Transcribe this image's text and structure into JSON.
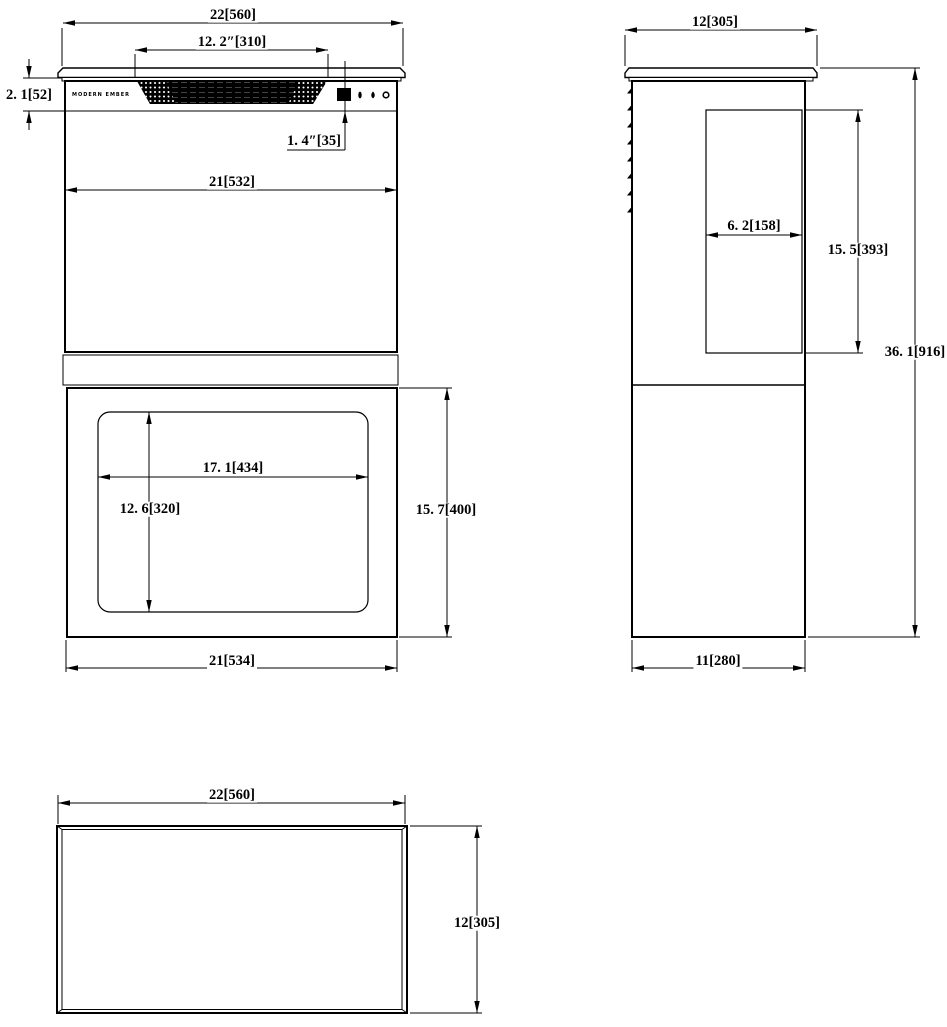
{
  "drawing_type": "three-view technical drawing",
  "brand_label": "MODERN EMBER",
  "colors": {
    "line": "#000000",
    "background": "#ffffff",
    "grille_fill": "#000000"
  },
  "dims": {
    "front": {
      "overall_width": "22[560]",
      "grille_width": "12. 2″[310]",
      "top_panel_height": "2. 1[52]",
      "display_width": "1. 4″[35]",
      "upper_body_width": "21[532]",
      "window_width": "17. 1[434]",
      "window_height": "12. 6[320]",
      "lower_box_height": "15. 7[400]",
      "lower_box_width": "21[534]"
    },
    "side": {
      "top_depth": "12[305]",
      "rear_box_depth": "6. 2[158]",
      "rear_box_height": "15. 5[393]",
      "overall_height": "36. 1[916]",
      "bottom_depth": "11[280]"
    },
    "bottom": {
      "width": "22[560]",
      "depth": "12[305]"
    }
  },
  "icons": {
    "display": "display-screen-icon",
    "control_1": "flame-dot-icon",
    "control_2": "flame-dot-icon",
    "control_3": "power-ring-icon"
  }
}
